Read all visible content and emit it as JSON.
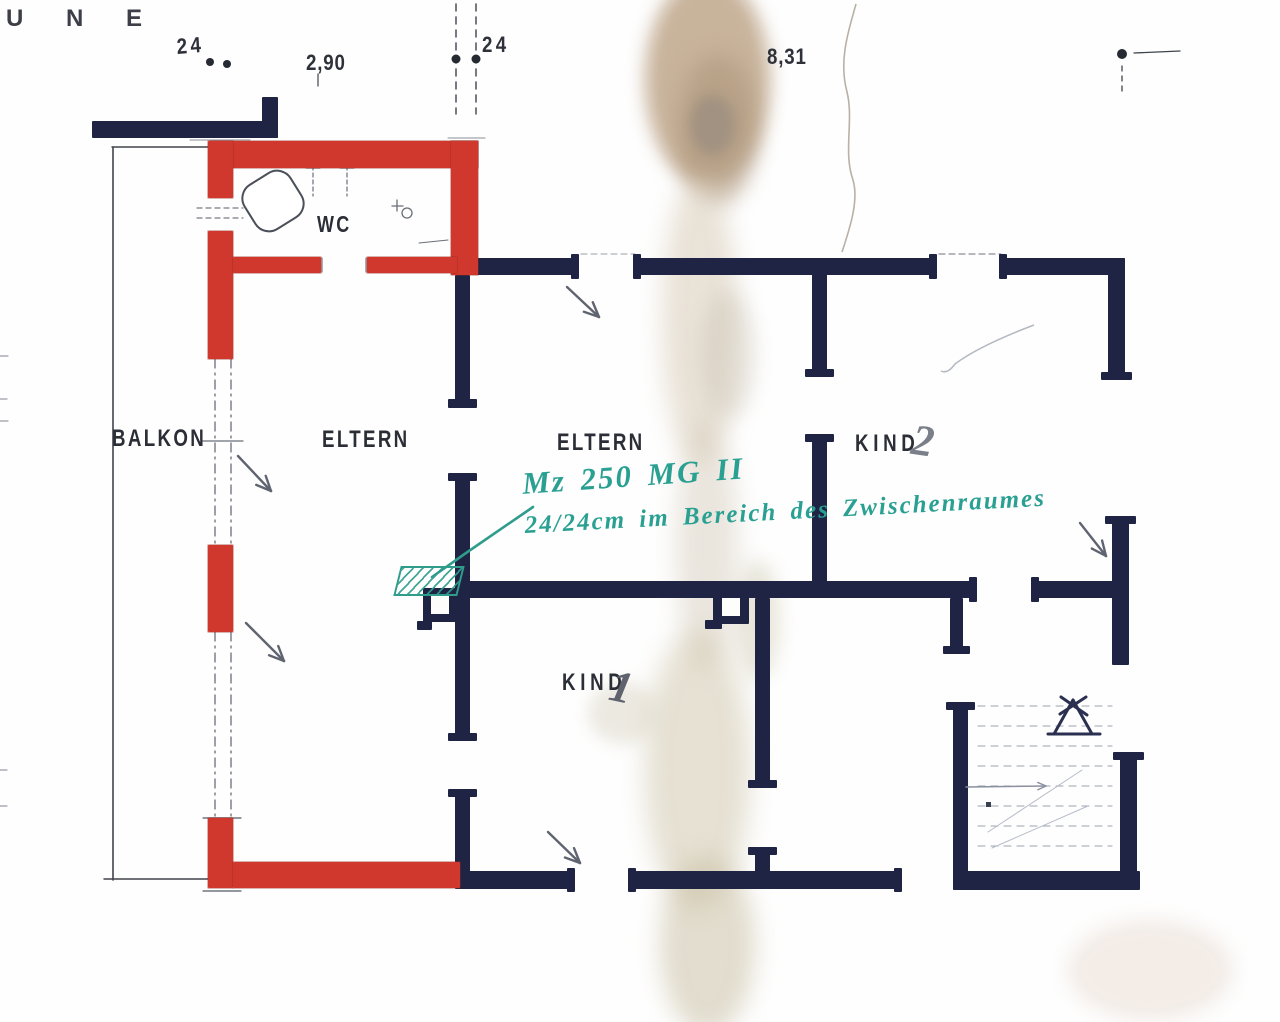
{
  "meta": {
    "title": "Scanned hand-drawn floor plan (first floor, bedrooms) with red masonry alterations and teal annotation"
  },
  "colors": {
    "paper": "#fefefe",
    "wall_navy": "#1f2444",
    "wall_red": "#d0382e",
    "teal": "#2f9c8c",
    "teal_text": "#2aa092",
    "pencil": "#5f6470",
    "label_ink": "#2b2e36"
  },
  "labels": [
    {
      "id": "fragment-une",
      "text": "U N E",
      "x": 6,
      "y": 7,
      "size": 24,
      "ls": 18,
      "sx": 1,
      "color": "#3c3f47",
      "cls": "tech",
      "rot": 0
    },
    {
      "id": "dim-24-left",
      "text": "24",
      "x": 176,
      "y": 36,
      "size": 22,
      "ls": 4,
      "sx": 0.85,
      "color": "#2e313a",
      "cls": "tech",
      "rot": -4
    },
    {
      "id": "dim-2-90",
      "text": "2,90",
      "x": 306,
      "y": 52,
      "size": 22,
      "ls": 1,
      "sx": 0.85,
      "color": "#2e313a",
      "cls": "tech",
      "rot": 0
    },
    {
      "id": "dim-24-mid",
      "text": "24",
      "x": 482,
      "y": 34,
      "size": 22,
      "ls": 4,
      "sx": 0.85,
      "color": "#2e313a",
      "cls": "tech",
      "rot": 0
    },
    {
      "id": "dim-8-31",
      "text": "8,31",
      "x": 767,
      "y": 46,
      "size": 22,
      "ls": 1,
      "sx": 0.85,
      "color": "#2e313a",
      "cls": "tech",
      "rot": 0
    },
    {
      "id": "room-balkon",
      "text": "BALKON",
      "x": 112,
      "y": 427,
      "size": 24,
      "ls": 3,
      "sx": 0.78,
      "color": "#2b2e36",
      "cls": "tech",
      "rot": 0
    },
    {
      "id": "room-eltern-west",
      "text": "ELTERN",
      "x": 322,
      "y": 428,
      "size": 24,
      "ls": 3,
      "sx": 0.78,
      "color": "#2b2e36",
      "cls": "tech",
      "rot": 0
    },
    {
      "id": "room-eltern-east",
      "text": "ELTERN",
      "x": 557,
      "y": 431,
      "size": 24,
      "ls": 3,
      "sx": 0.78,
      "color": "#2b2e36",
      "cls": "tech",
      "rot": 0
    },
    {
      "id": "room-kind2",
      "text": "KIND",
      "x": 855,
      "y": 432,
      "size": 24,
      "ls": 6,
      "sx": 0.78,
      "color": "#2b2e36",
      "cls": "tech",
      "rot": 0
    },
    {
      "id": "room-kind2-number",
      "text": "2",
      "x": 915,
      "y": 418,
      "size": 44,
      "ls": 0,
      "sx": 1,
      "color": "#7b7f89",
      "cls": "hand",
      "rot": 8
    },
    {
      "id": "room-kind1",
      "text": "KIND",
      "x": 562,
      "y": 671,
      "size": 24,
      "ls": 6,
      "sx": 0.78,
      "color": "#2b2e36",
      "cls": "tech",
      "rot": 0
    },
    {
      "id": "room-kind1-number",
      "text": "1",
      "x": 615,
      "y": 663,
      "size": 45,
      "ls": 0,
      "sx": 1,
      "color": "#5f636d",
      "cls": "hand",
      "rot": 12
    },
    {
      "id": "room-wc",
      "text": "WC",
      "x": 317,
      "y": 213,
      "size": 23,
      "ls": 3,
      "sx": 0.78,
      "color": "#2b2e36",
      "cls": "tech",
      "rot": 0
    }
  ],
  "annotation": {
    "line1": {
      "text": "Mz 250 MG II",
      "x": 521,
      "y": 466,
      "size": 31,
      "rot": -4
    },
    "line2": {
      "text": "24/24cm im Bereich des Zwischenraumes",
      "x": 524,
      "y": 512,
      "size": 25,
      "rot": -3
    },
    "leader_points": "533,507 466,553 432,577",
    "hatch": {
      "x": 397,
      "y": 566,
      "w": 60,
      "h": 26,
      "skew": -14
    }
  },
  "walls_navy": [
    [
      92,
      121,
      186,
      17
    ],
    [
      262,
      97,
      16,
      41
    ],
    [
      455,
      258,
      124,
      17
    ],
    [
      571,
      254,
      8,
      25
    ],
    [
      637,
      258,
      300,
      17
    ],
    [
      633,
      254,
      8,
      25
    ],
    [
      929,
      254,
      8,
      25
    ],
    [
      1003,
      258,
      122,
      17
    ],
    [
      999,
      254,
      8,
      25
    ],
    [
      1108,
      258,
      17,
      122
    ],
    [
      1101,
      372,
      31,
      8
    ],
    [
      812,
      258,
      15,
      117
    ],
    [
      805,
      369,
      29,
      8
    ],
    [
      812,
      438,
      15,
      160
    ],
    [
      805,
      434,
      29,
      8
    ],
    [
      455,
      581,
      522,
      17
    ],
    [
      969,
      577,
      8,
      25
    ],
    [
      1035,
      581,
      78,
      17
    ],
    [
      1031,
      577,
      8,
      25
    ],
    [
      950,
      598,
      13,
      54
    ],
    [
      943,
      646,
      27,
      8
    ],
    [
      1112,
      520,
      17,
      145
    ],
    [
      1105,
      516,
      31,
      8
    ],
    [
      455,
      275,
      15,
      130
    ],
    [
      448,
      399,
      29,
      9
    ],
    [
      455,
      477,
      15,
      260
    ],
    [
      448,
      473,
      29,
      8
    ],
    [
      448,
      733,
      29,
      8
    ],
    [
      455,
      793,
      15,
      95
    ],
    [
      448,
      789,
      29,
      8
    ],
    [
      417,
      621,
      15,
      9
    ],
    [
      705,
      620,
      17,
      9
    ],
    [
      755,
      598,
      15,
      186
    ],
    [
      748,
      780,
      29,
      8
    ],
    [
      755,
      851,
      15,
      37
    ],
    [
      748,
      847,
      29,
      8
    ],
    [
      455,
      871,
      116,
      18
    ],
    [
      567,
      868,
      8,
      24
    ],
    [
      632,
      871,
      266,
      18
    ],
    [
      628,
      868,
      8,
      24
    ],
    [
      894,
      868,
      8,
      24
    ],
    [
      953,
      706,
      15,
      184
    ],
    [
      946,
      702,
      29,
      8
    ],
    [
      1120,
      756,
      17,
      134
    ],
    [
      1113,
      752,
      31,
      8
    ],
    [
      953,
      871,
      187,
      19
    ]
  ],
  "pillars": [
    {
      "x": 423,
      "y": 588,
      "w": 34,
      "h": 34,
      "inner": [
        8,
        8,
        18,
        18
      ]
    },
    {
      "x": 713,
      "y": 589,
      "w": 36,
      "h": 35,
      "inner": [
        9,
        9,
        18,
        18
      ]
    }
  ],
  "walls_red": [
    [
      210,
      141,
      268,
      27
    ],
    [
      208,
      141,
      25,
      57
    ],
    [
      208,
      231,
      25,
      128
    ],
    [
      451,
      141,
      27,
      134
    ],
    [
      233,
      257,
      88,
      16
    ],
    [
      367,
      257,
      90,
      16
    ],
    [
      208,
      545,
      25,
      87
    ],
    [
      208,
      818,
      25,
      70
    ],
    [
      233,
      862,
      227,
      26
    ]
  ],
  "pencil_lines": [
    {
      "p": [
        113,
        147,
        113,
        880
      ],
      "w": 1.6,
      "c": "#41444c"
    },
    {
      "p": [
        112,
        147,
        211,
        147
      ],
      "w": 1.4,
      "c": "#41444c"
    },
    {
      "p": [
        104,
        879,
        209,
        879
      ],
      "w": 1.4,
      "c": "#41444c"
    },
    {
      "p": [
        215,
        359,
        215,
        546
      ],
      "w": 1.3,
      "c": "#6a6e78",
      "d": "9 5 2 5"
    },
    {
      "p": [
        231,
        359,
        231,
        546
      ],
      "w": 1.3,
      "c": "#6a6e78",
      "d": "9 5 2 5"
    },
    {
      "p": [
        203,
        441,
        243,
        441
      ],
      "w": 1.2,
      "c": "#6a6e78"
    },
    {
      "p": [
        215,
        632,
        215,
        818
      ],
      "w": 1.3,
      "c": "#6a6e78",
      "d": "9 5 2 5"
    },
    {
      "p": [
        231,
        632,
        231,
        818
      ],
      "w": 1.3,
      "c": "#6a6e78",
      "d": "9 5 2 5"
    },
    {
      "p": [
        197,
        208,
        243,
        208
      ],
      "w": 1.2,
      "c": "#777c85",
      "d": "5 4"
    },
    {
      "p": [
        197,
        218,
        243,
        218
      ],
      "w": 1.2,
      "c": "#777c85",
      "d": "5 4"
    },
    {
      "p": [
        322,
        258,
        322,
        272
      ],
      "w": 1.2,
      "c": "#777c85"
    },
    {
      "p": [
        366,
        258,
        366,
        272
      ],
      "w": 1.2,
      "c": "#777c85"
    },
    {
      "p": [
        456,
        4,
        456,
        114
      ],
      "w": 1.4,
      "c": "#3f434c",
      "d": "7 6"
    },
    {
      "p": [
        476,
        4,
        476,
        114
      ],
      "w": 1.4,
      "c": "#3f434c",
      "d": "7 6"
    },
    {
      "p": [
        318,
        74,
        318,
        86
      ],
      "w": 1.2,
      "c": "#3f434c"
    },
    {
      "p": [
        1134,
        53,
        1180,
        51
      ],
      "w": 1.3,
      "c": "#3f434c"
    },
    {
      "p": [
        1122,
        66,
        1122,
        96
      ],
      "w": 1.3,
      "c": "#3f434c",
      "d": "5 5"
    },
    {
      "p": [
        203,
        818,
        241,
        818
      ],
      "w": 1.2,
      "c": "#555a63"
    },
    {
      "p": [
        203,
        891,
        241,
        891
      ],
      "w": 1.2,
      "c": "#555a63"
    },
    {
      "p": [
        939,
        254,
        1001,
        254
      ],
      "w": 1.2,
      "c": "#8a8e98",
      "d": "6 4"
    },
    {
      "p": [
        581,
        254,
        635,
        254
      ],
      "w": 1.1,
      "c": "#9aa0a8",
      "d": "6 4"
    },
    {
      "p": [
        190,
        140,
        250,
        140
      ],
      "w": 1.1,
      "c": "#8a8e98"
    },
    {
      "p": [
        448,
        138,
        485,
        138
      ],
      "w": 1.1,
      "c": "#8a8e98"
    },
    {
      "p": [
        0,
        356,
        8,
        356
      ],
      "w": 1.2,
      "c": "#9a9da5"
    },
    {
      "p": [
        0,
        399,
        7,
        399
      ],
      "w": 1.2,
      "c": "#9a9da5"
    },
    {
      "p": [
        0,
        421,
        8,
        421
      ],
      "w": 1.2,
      "c": "#9a9da5"
    },
    {
      "p": [
        0,
        770,
        7,
        770
      ],
      "w": 1.2,
      "c": "#9a9da5"
    },
    {
      "p": [
        0,
        806,
        7,
        806
      ],
      "w": 1.2,
      "c": "#9a9da5"
    },
    {
      "p": [
        313,
        166,
        313,
        196
      ],
      "w": 1.2,
      "c": "#6a6e78",
      "d": "4 3"
    },
    {
      "p": [
        347,
        166,
        347,
        196
      ],
      "w": 1.2,
      "c": "#6a6e78",
      "d": "4 3"
    },
    {
      "p": [
        306,
        168,
        320,
        168
      ],
      "w": 1.0,
      "c": "#6a6e78"
    },
    {
      "p": [
        340,
        168,
        354,
        168
      ],
      "w": 1.0,
      "c": "#6a6e78"
    },
    {
      "p": [
        419,
        243,
        448,
        240
      ],
      "w": 1.1,
      "c": "#6a6e78"
    },
    {
      "p": [
        392,
        206,
        403,
        206
      ],
      "w": 1.3,
      "c": "#6a6e78"
    },
    {
      "p": [
        397,
        200,
        397,
        211
      ],
      "w": 1.3,
      "c": "#6a6e78"
    }
  ],
  "dots": [
    [
      210,
      62,
      4
    ],
    [
      227,
      64,
      4
    ],
    [
      456,
      59,
      4.5
    ],
    [
      476,
      59,
      4.5
    ],
    [
      1122,
      54,
      5
    ]
  ],
  "small_circle": {
    "cx": 407,
    "cy": 213,
    "r": 5
  },
  "arrows": [
    {
      "p": [
        567,
        287,
        599,
        317
      ],
      "w": 2.4,
      "c": "#5f6470",
      "head": 16
    },
    {
      "p": [
        238,
        456,
        271,
        491
      ],
      "w": 2.4,
      "c": "#5f6470",
      "head": 16
    },
    {
      "p": [
        246,
        623,
        284,
        661
      ],
      "w": 2.4,
      "c": "#5f6470",
      "head": 16
    },
    {
      "p": [
        548,
        832,
        580,
        863
      ],
      "w": 2.4,
      "c": "#5f6470",
      "head": 16
    },
    {
      "p": [
        1080,
        523,
        1106,
        556
      ],
      "w": 2.4,
      "c": "#5f6470",
      "head": 16
    },
    {
      "p": [
        966,
        787,
        1046,
        786
      ],
      "w": 1.4,
      "c": "#8b90a0",
      "head": 9
    }
  ],
  "stairs": {
    "treads": {
      "x1": 978,
      "x2": 1112,
      "y_start": 706,
      "step": 20,
      "count": 8,
      "c": "#9aa1b0",
      "w": 1.1,
      "d": "7 6"
    },
    "diagonals": [
      [
        988,
        832,
        1082,
        770
      ],
      [
        992,
        848,
        1088,
        806
      ]
    ],
    "dot": [
      986,
      802,
      5,
      5
    ],
    "marker_lines": [
      [
        1048,
        734,
        1100,
        734
      ],
      [
        1073,
        700,
        1054,
        734
      ],
      [
        1073,
        700,
        1092,
        734
      ],
      [
        1060,
        714,
        1086,
        697
      ],
      [
        1061,
        697,
        1087,
        715
      ]
    ],
    "marker_color": "#2b3050",
    "marker_w": 3
  },
  "toilet": {
    "x": 246,
    "y": 175,
    "w": 54,
    "h": 52,
    "rx": 16,
    "rot": -32,
    "cx": 273,
    "cy": 201,
    "stroke": "#4b4f59"
  },
  "faint_paths": [
    {
      "d": "M856,4 C847,36 839,62 847,92 C854,120 843,152 853,180 C859,200 850,228 842,252",
      "c": "#b8b1a5",
      "w": 1.6
    },
    {
      "d": "M941,371 C947,374 952,368 955,364 C975,349 1005,336 1034,325",
      "c": "#b4b8c2",
      "w": 1.5
    }
  ],
  "stains": [
    {
      "x": 645,
      "y": -25,
      "w": 125,
      "h": 210,
      "c": "rgba(182,153,122,0.75)",
      "b": 9
    },
    {
      "x": 678,
      "y": 55,
      "w": 80,
      "h": 150,
      "c": "rgba(172,148,120,0.55)",
      "b": 10
    },
    {
      "x": 690,
      "y": 95,
      "w": 45,
      "h": 60,
      "c": "rgba(140,130,122,0.50)",
      "b": 6
    },
    {
      "x": 662,
      "y": 175,
      "w": 75,
      "h": 290,
      "c": "rgba(213,199,178,0.50)",
      "b": 12
    },
    {
      "x": 676,
      "y": 420,
      "w": 62,
      "h": 250,
      "c": "rgba(208,196,176,0.42)",
      "b": 12
    },
    {
      "x": 645,
      "y": 630,
      "w": 105,
      "h": 280,
      "c": "rgba(205,196,168,0.50)",
      "b": 13
    },
    {
      "x": 660,
      "y": 855,
      "w": 95,
      "h": 180,
      "c": "rgba(198,188,158,0.50)",
      "b": 12
    },
    {
      "x": 588,
      "y": 682,
      "w": 70,
      "h": 62,
      "c": "rgba(216,209,190,0.45)",
      "b": 8
    },
    {
      "x": 1068,
      "y": 920,
      "w": 165,
      "h": 100,
      "c": "rgba(234,220,211,0.55)",
      "b": 10
    },
    {
      "x": 700,
      "y": 290,
      "w": 55,
      "h": 130,
      "c": "rgba(196,186,170,0.35)",
      "b": 10
    },
    {
      "x": 735,
      "y": 560,
      "w": 45,
      "h": 120,
      "c": "rgba(200,196,168,0.40)",
      "b": 9
    }
  ]
}
